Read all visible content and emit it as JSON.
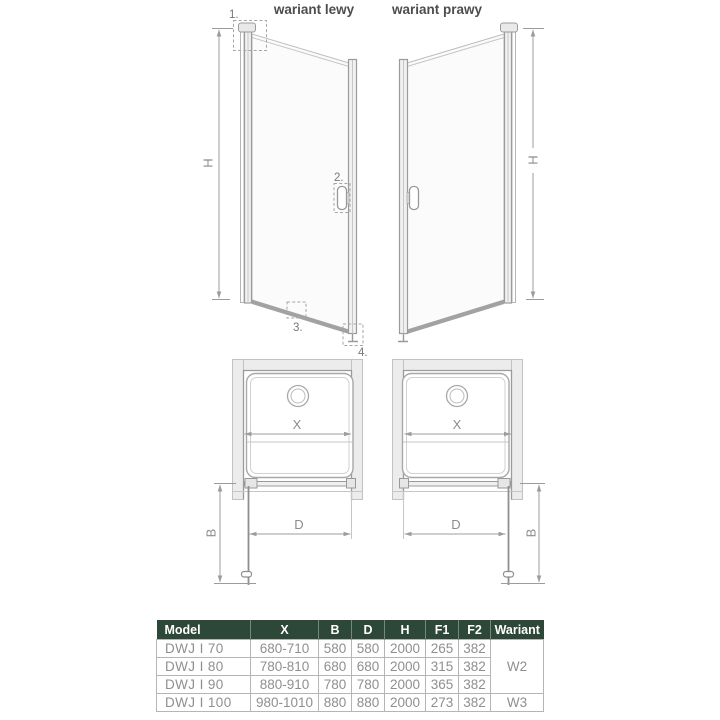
{
  "header": {
    "left_variant": "wariant lewy",
    "right_variant": "wariant prawy"
  },
  "labels": {
    "height": "H",
    "width_x": "X",
    "door_d": "D",
    "depth_b": "B",
    "callout_1": "1.",
    "callout_2": "2.",
    "callout_3": "3.",
    "callout_4": "4."
  },
  "colors": {
    "table_header_bg": "#2d4738",
    "table_header_text": "#ffffff",
    "table_body_text": "#8f8f8f",
    "table_border": "#b5b5b5",
    "diagram_line": "#9b9b9b",
    "dimension_line": "#9c9c9c",
    "wall_fill": "#ececec",
    "title_text": "#4d4d4d"
  },
  "table": {
    "headers": [
      "Model",
      "X",
      "B",
      "D",
      "H",
      "F1",
      "F2",
      "Wariant"
    ],
    "rows": [
      {
        "model": "DWJ I 70",
        "x": "680-710",
        "b": "580",
        "d": "580",
        "h": "2000",
        "f1": "265",
        "f2": "382"
      },
      {
        "model": "DWJ I 80",
        "x": "780-810",
        "b": "680",
        "d": "680",
        "h": "2000",
        "f1": "315",
        "f2": "382"
      },
      {
        "model": "DWJ I 90",
        "x": "880-910",
        "b": "780",
        "d": "780",
        "h": "2000",
        "f1": "365",
        "f2": "382"
      },
      {
        "model": "DWJ I 100",
        "x": "980-1010",
        "b": "880",
        "d": "880",
        "h": "2000",
        "f1": "273",
        "f2": "382"
      }
    ],
    "variant_w2": "W2",
    "variant_w3": "W3"
  }
}
